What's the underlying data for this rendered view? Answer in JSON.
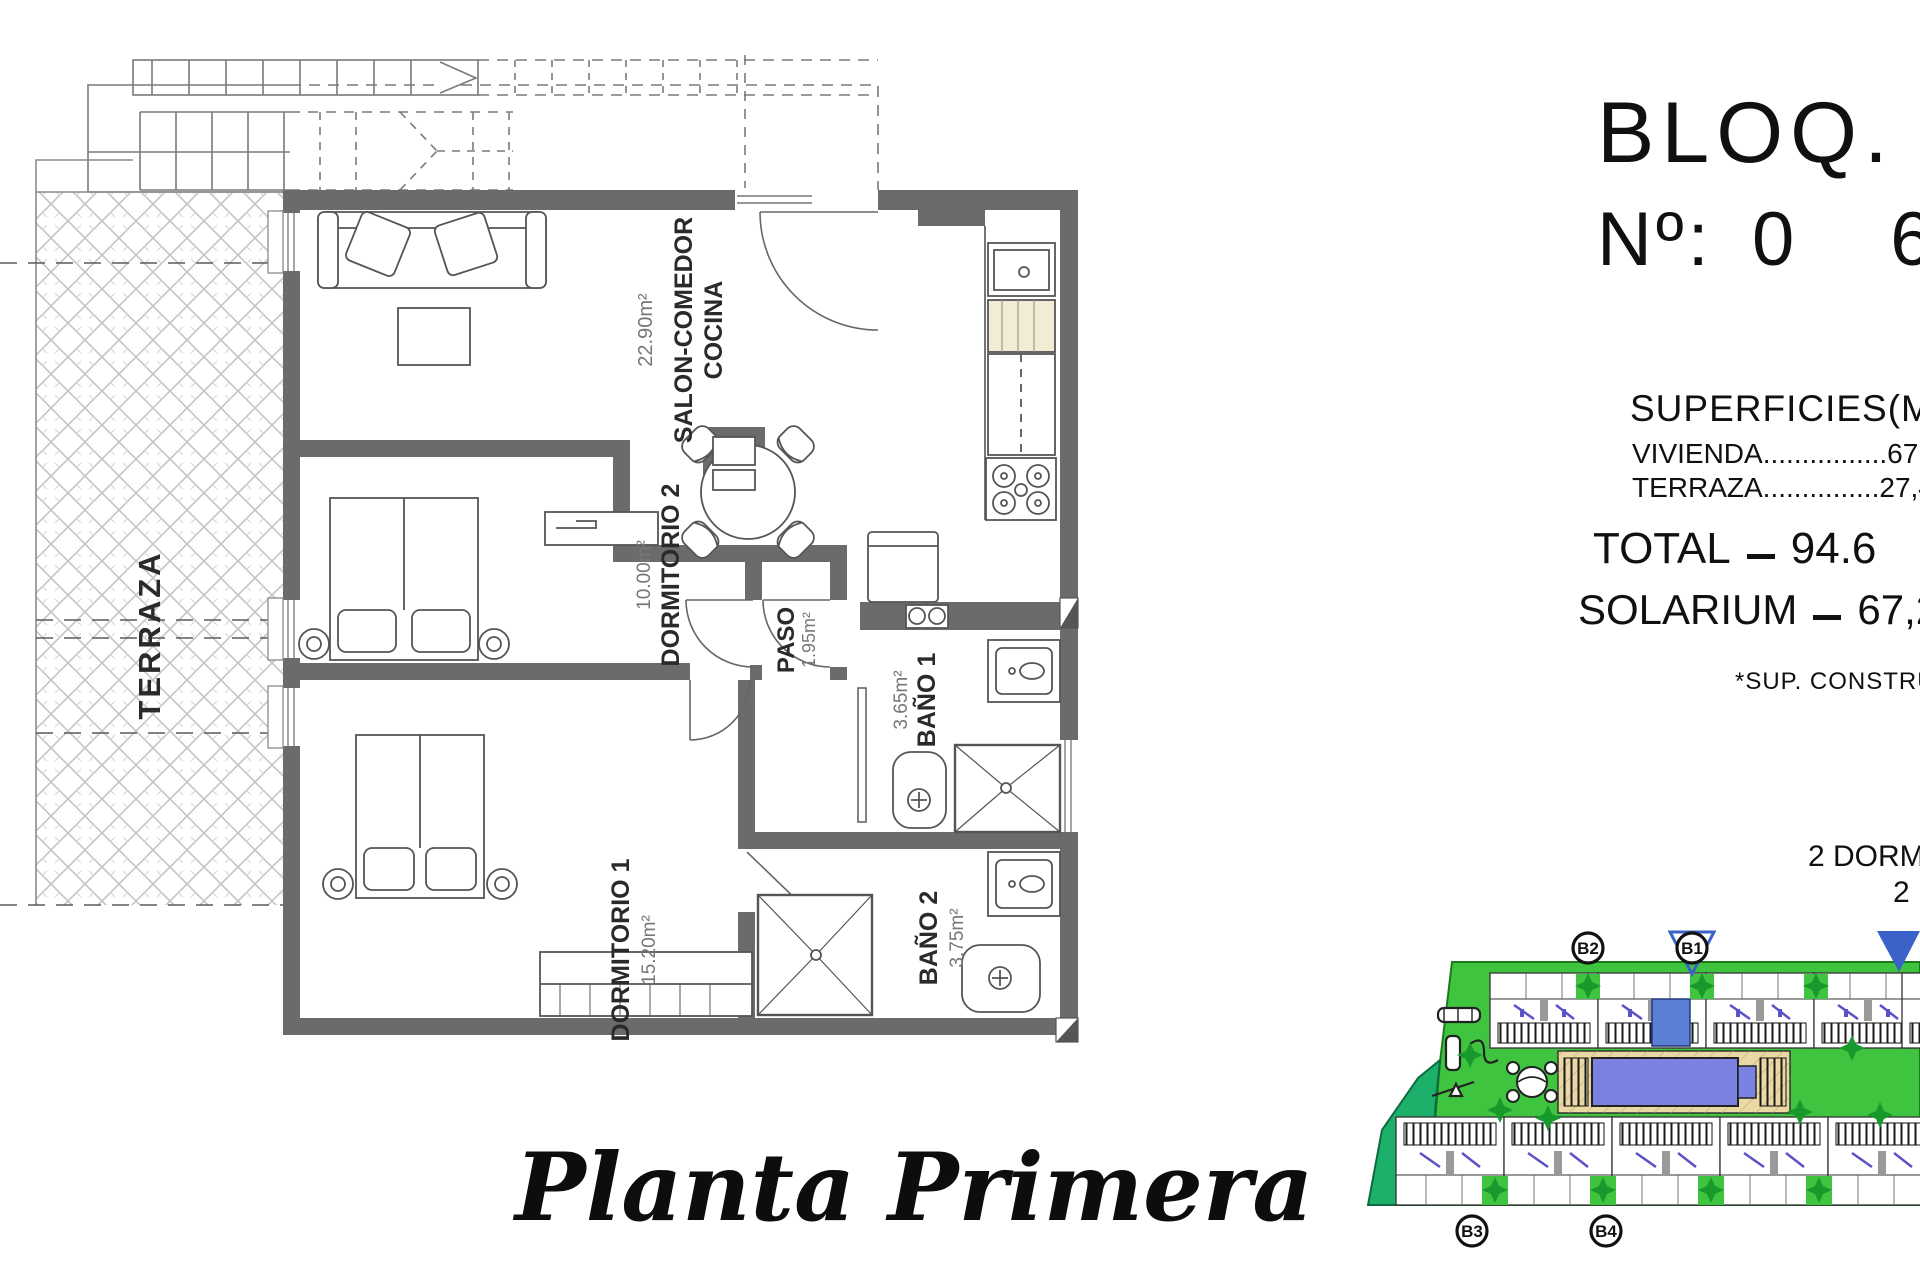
{
  "floor_plan": {
    "caption": "Planta Primera",
    "terraza": {
      "name": "TERRAZA"
    },
    "salon": {
      "name_line1": "SALON-COMEDOR",
      "name_line2": "COCINA",
      "area": "22.90m²"
    },
    "dormitorio2": {
      "name": "DORMITORIO 2",
      "area": "10.00m²"
    },
    "paso": {
      "name": "PASO",
      "area": "1.95m²"
    },
    "bano1": {
      "name": "BAÑO 1",
      "area": "3.65m²"
    },
    "dormitorio1": {
      "name": "DORMITORIO 1",
      "area": "15.20m²"
    },
    "bano2": {
      "name": "BAÑO 2",
      "area": "3.75m²"
    }
  },
  "info_panel": {
    "block_label": "BLOQ.",
    "number_label": "Nº:",
    "number_value": "06",
    "surfaces_title": "SUPERFICIES(M²)",
    "surface_row1": "VIVIENDA................67,2",
    "surface_row2": "TERRAZA...............27,4",
    "total_label": "TOTAL",
    "total_value": "94.6",
    "solarium_label": "SOLARIUM",
    "solarium_value": "67,2",
    "footnote": "*SUP. CONSTRUIDA",
    "feature_line1": "2 DORMI",
    "feature_line2": "2"
  },
  "site_plan": {
    "block_labels": {
      "b1": "B1",
      "b2": "B2",
      "b3": "B3",
      "b4": "B4"
    },
    "colors": {
      "lawn": "#3fc43f",
      "lawn_dark": "#1db06b",
      "pool": "#7b81e0",
      "deck": "#ead9a4",
      "unit_highlight": "#5b7fd4",
      "marker_blue": "#3a62c8",
      "tree": "#17992c"
    }
  }
}
